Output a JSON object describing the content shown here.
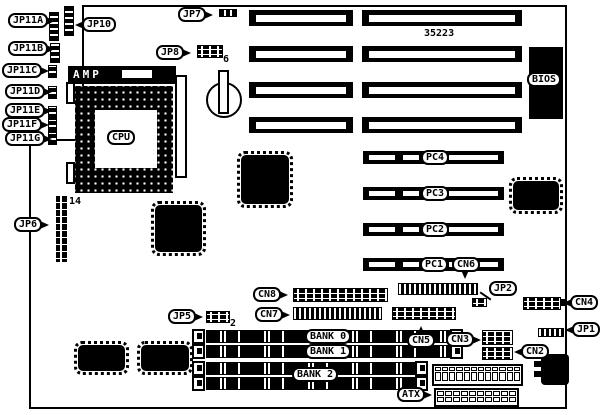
{
  "diagram": {
    "type": "motherboard-layout",
    "part_number": "35223",
    "cpu": {
      "socket_brand": "AMP",
      "label": "CPU"
    },
    "bios_label": "BIOS",
    "jumpers": {
      "jp11a": "JP11A",
      "jp11b": "JP11B",
      "jp11c": "JP11C",
      "jp11d": "JP11D",
      "jp11e": "JP11E",
      "jp11f": "JP11F",
      "jp11g": "JP11G",
      "jp10": "JP10",
      "jp7": "JP7",
      "jp8": "JP8",
      "jp6": "JP6",
      "jp5": "JP5",
      "jp2": "JP2",
      "jp1": "JP1"
    },
    "connectors": {
      "cn2": "CN2",
      "cn3": "CN3",
      "cn4": "CN4",
      "cn5": "CN5",
      "cn6": "CN6",
      "cn7": "CN7",
      "cn8": "CN8",
      "atx": "ATX"
    },
    "pci_slots": [
      "PC1",
      "PC2",
      "PC3",
      "PC4"
    ],
    "memory_banks": [
      "BANK 0",
      "BANK 1",
      "BANK 2"
    ],
    "pin_labels": {
      "jp6_pins": "14",
      "jp8_pin": "6",
      "jp5_pin": "2"
    }
  }
}
